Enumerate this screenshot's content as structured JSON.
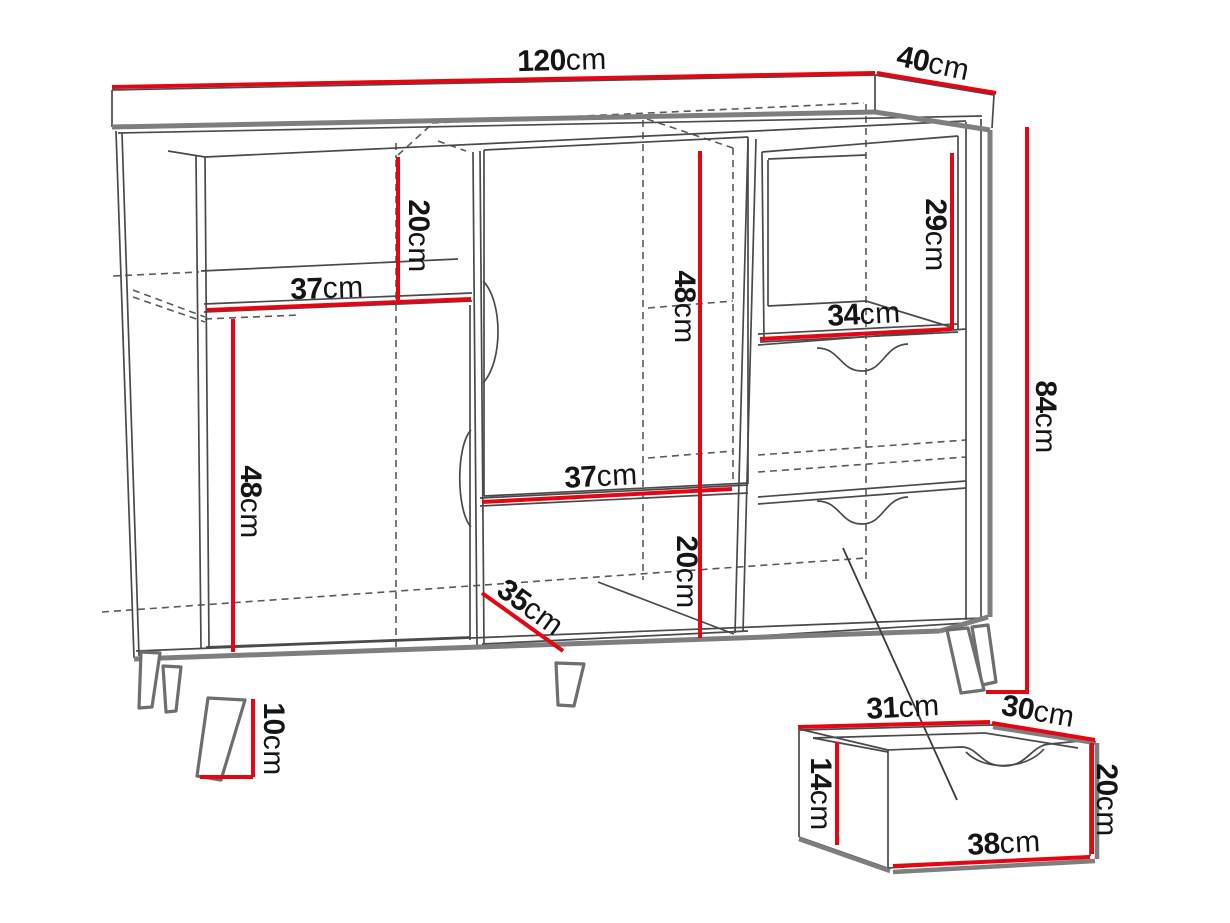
{
  "diagram": {
    "accent_color": "#e60613",
    "cabinet": {
      "width": {
        "v": "120",
        "u": "cm"
      },
      "depth": {
        "v": "40",
        "u": "cm"
      },
      "height": {
        "v": "84",
        "u": "cm"
      },
      "left_niche_height": {
        "v": "20",
        "u": "cm"
      },
      "left_niche_width": {
        "v": "37",
        "u": "cm"
      },
      "left_door_height": {
        "v": "48",
        "u": "cm"
      },
      "middle_door_height": {
        "v": "48",
        "u": "cm"
      },
      "middle_shelf_width": {
        "v": "37",
        "u": "cm"
      },
      "bottom_niche_height": {
        "v": "20",
        "u": "cm"
      },
      "bottom_niche_depth": {
        "v": "35",
        "u": "cm"
      },
      "right_niche_height": {
        "v": "29",
        "u": "cm"
      },
      "right_niche_width": {
        "v": "34",
        "u": "cm"
      },
      "leg_height": {
        "v": "10",
        "u": "cm"
      }
    },
    "drawer_detail": {
      "inner_width": {
        "v": "31",
        "u": "cm"
      },
      "depth": {
        "v": "30",
        "u": "cm"
      },
      "side_height": {
        "v": "14",
        "u": "cm"
      },
      "front_height": {
        "v": "20",
        "u": "cm"
      },
      "front_width": {
        "v": "38",
        "u": "cm"
      }
    }
  }
}
